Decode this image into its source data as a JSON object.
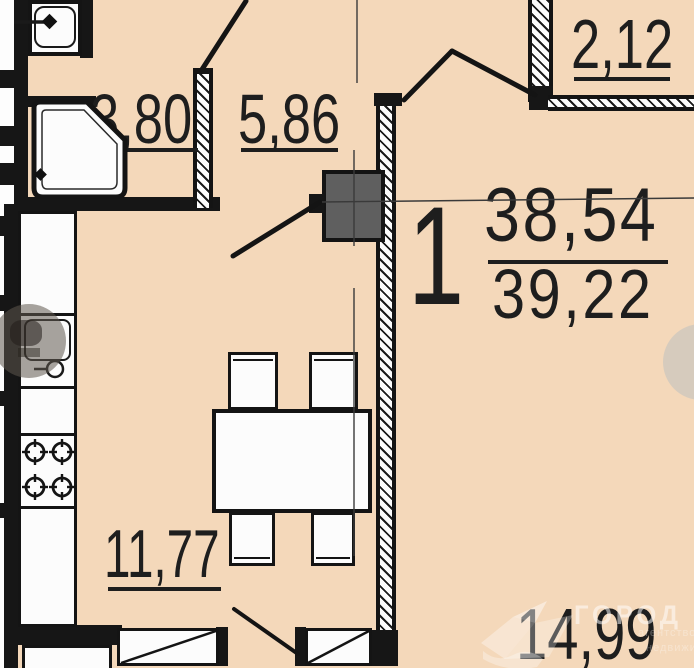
{
  "plan": {
    "unit_label": "1",
    "areas": {
      "bathroom": "3,80",
      "hallway": "5,86",
      "balcony": "2,12",
      "kitchen_living": "11,77",
      "room": "14,99",
      "living_area": "38,54",
      "total_area": "39,22"
    }
  },
  "watermark": {
    "brand": "ГОРОД",
    "subline1": "агентство",
    "subline2": "недвижимости"
  },
  "colors": {
    "floor_fill": "#f4d8ba",
    "wall": "#161616",
    "text": "#1e1e1e",
    "vent_shaft_fill": "#5f5f5f",
    "watermark_white": "rgba(255,255,255,0.5)"
  }
}
